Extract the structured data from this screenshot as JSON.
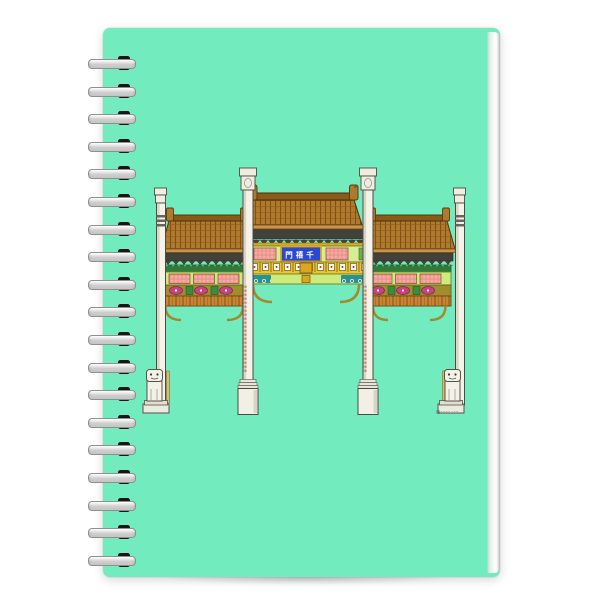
{
  "cover": {
    "color": "#72ecbf"
  },
  "binding": {
    "coil_count": 19
  },
  "illustration": {
    "plaque": {
      "text_display": "門禧千",
      "text_reading": "千禧門",
      "bg_color": "#2b49d0",
      "frame_color": "#d8a81f",
      "text_color": "#ffffff"
    },
    "signature": "@······ ····",
    "colors": {
      "roof_brown": "#b07a2e",
      "column_cream": "#f5f2e8",
      "band_light_green": "#cdeb7d",
      "panel_salmon": "#f5aaa2",
      "band_yellow": "#e9c531",
      "band_olive": "#a08d2e",
      "medallion_magenta": "#c9417e",
      "teal_scroll": "#2e8f8f",
      "dark_green": "#2e7a3c",
      "eave_dark": "#43423a"
    }
  }
}
